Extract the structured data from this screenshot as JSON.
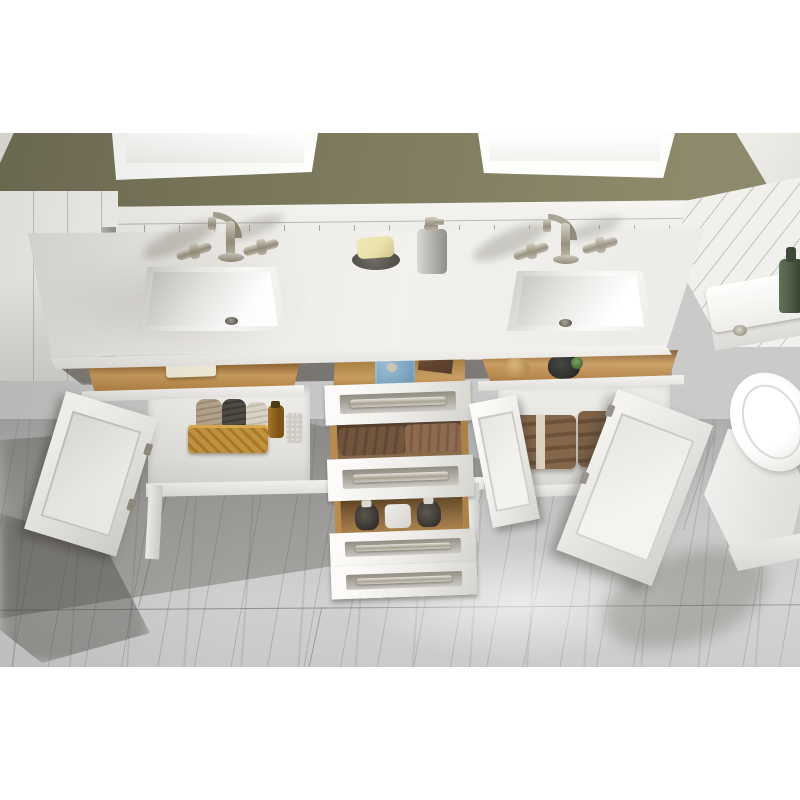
{
  "type": "product-photograph",
  "alt": "Top-down photo of a white double-sink bathroom vanity with quartz top, brushed-nickel widespread faucets, open tilt-out trays and three open center drawers holding towels and bottles, open cabinet doors revealing a basket of rolled towels and folded brown towels, flanked by a white linen cabinet, a toilet on an olive-green wall bathroom with white wainscoting, two framed mirrors and gray marble tile floor",
  "palette": {
    "wall-green": "#7b785c",
    "wainscot-white": "#f3f2ee",
    "counter-white": "#eceae6",
    "counter-edge": "#f8f7f4",
    "cabinet-white": "#f4f3f0",
    "cabinet-shadow": "#d8d7d3",
    "drawer-wood": "#c79a5c",
    "drawer-wood-dark": "#7e5526",
    "towel-brown": "#6e5138",
    "towel-brown-light": "#8a664a",
    "cloth-blue": "#7ca4c0",
    "basket-gold": "#c2923d",
    "soap-yellow": "#e9e2ab",
    "metal-nickel": "#a39e8f",
    "floor-gray": "#c6c6c6",
    "floor-shadow": "#55524a",
    "mirror-white": "#fdfdfc",
    "bottle-green": "#3c4b31",
    "bottle-amber": "#8a5c1e"
  },
  "objects": [
    {
      "name": "olive-wall",
      "label": "olive green painted wall"
    },
    {
      "name": "mirror-left",
      "label": "left white framed mirror"
    },
    {
      "name": "mirror-right",
      "label": "right white framed mirror"
    },
    {
      "name": "wainscoting",
      "label": "white beadboard wainscot backsplash"
    },
    {
      "name": "linen-cabinet",
      "label": "white linen side cabinet"
    },
    {
      "name": "countertop",
      "label": "white quartz double countertop"
    },
    {
      "name": "sink-left",
      "label": "left rectangular undermount sink"
    },
    {
      "name": "sink-right",
      "label": "right rectangular undermount sink"
    },
    {
      "name": "faucet-left",
      "label": "brushed nickel widespread faucet"
    },
    {
      "name": "faucet-right",
      "label": "brushed nickel widespread faucet"
    },
    {
      "name": "soap-dish",
      "label": "gray soap dish with yellow soap bar"
    },
    {
      "name": "soap-dispenser",
      "label": "gray pump soap dispenser"
    },
    {
      "name": "tilt-tray-left",
      "label": "open tilt-out tray with soap"
    },
    {
      "name": "drawer-top-open",
      "label": "open top drawer with blue washcloth and wooden box"
    },
    {
      "name": "tilt-tray-right",
      "label": "open tilt-out tray with puck and dark bottle"
    },
    {
      "name": "drawer-middle-open",
      "label": "open middle drawer with brown towels"
    },
    {
      "name": "drawer-bottom-open",
      "label": "open deep drawer with glass bottles"
    },
    {
      "name": "door-left-open",
      "label": "open left cabinet door"
    },
    {
      "name": "basket",
      "label": "gold wire basket with rolled towels"
    },
    {
      "name": "cabinet-right-towels",
      "label": "folded brown towels tied with ribbon"
    },
    {
      "name": "doors-right-open",
      "label": "open right cabinet doors"
    },
    {
      "name": "toilet",
      "label": "white toilet with green bottle on tank"
    },
    {
      "name": "marble-floor",
      "label": "gray marble tile floor"
    }
  ]
}
